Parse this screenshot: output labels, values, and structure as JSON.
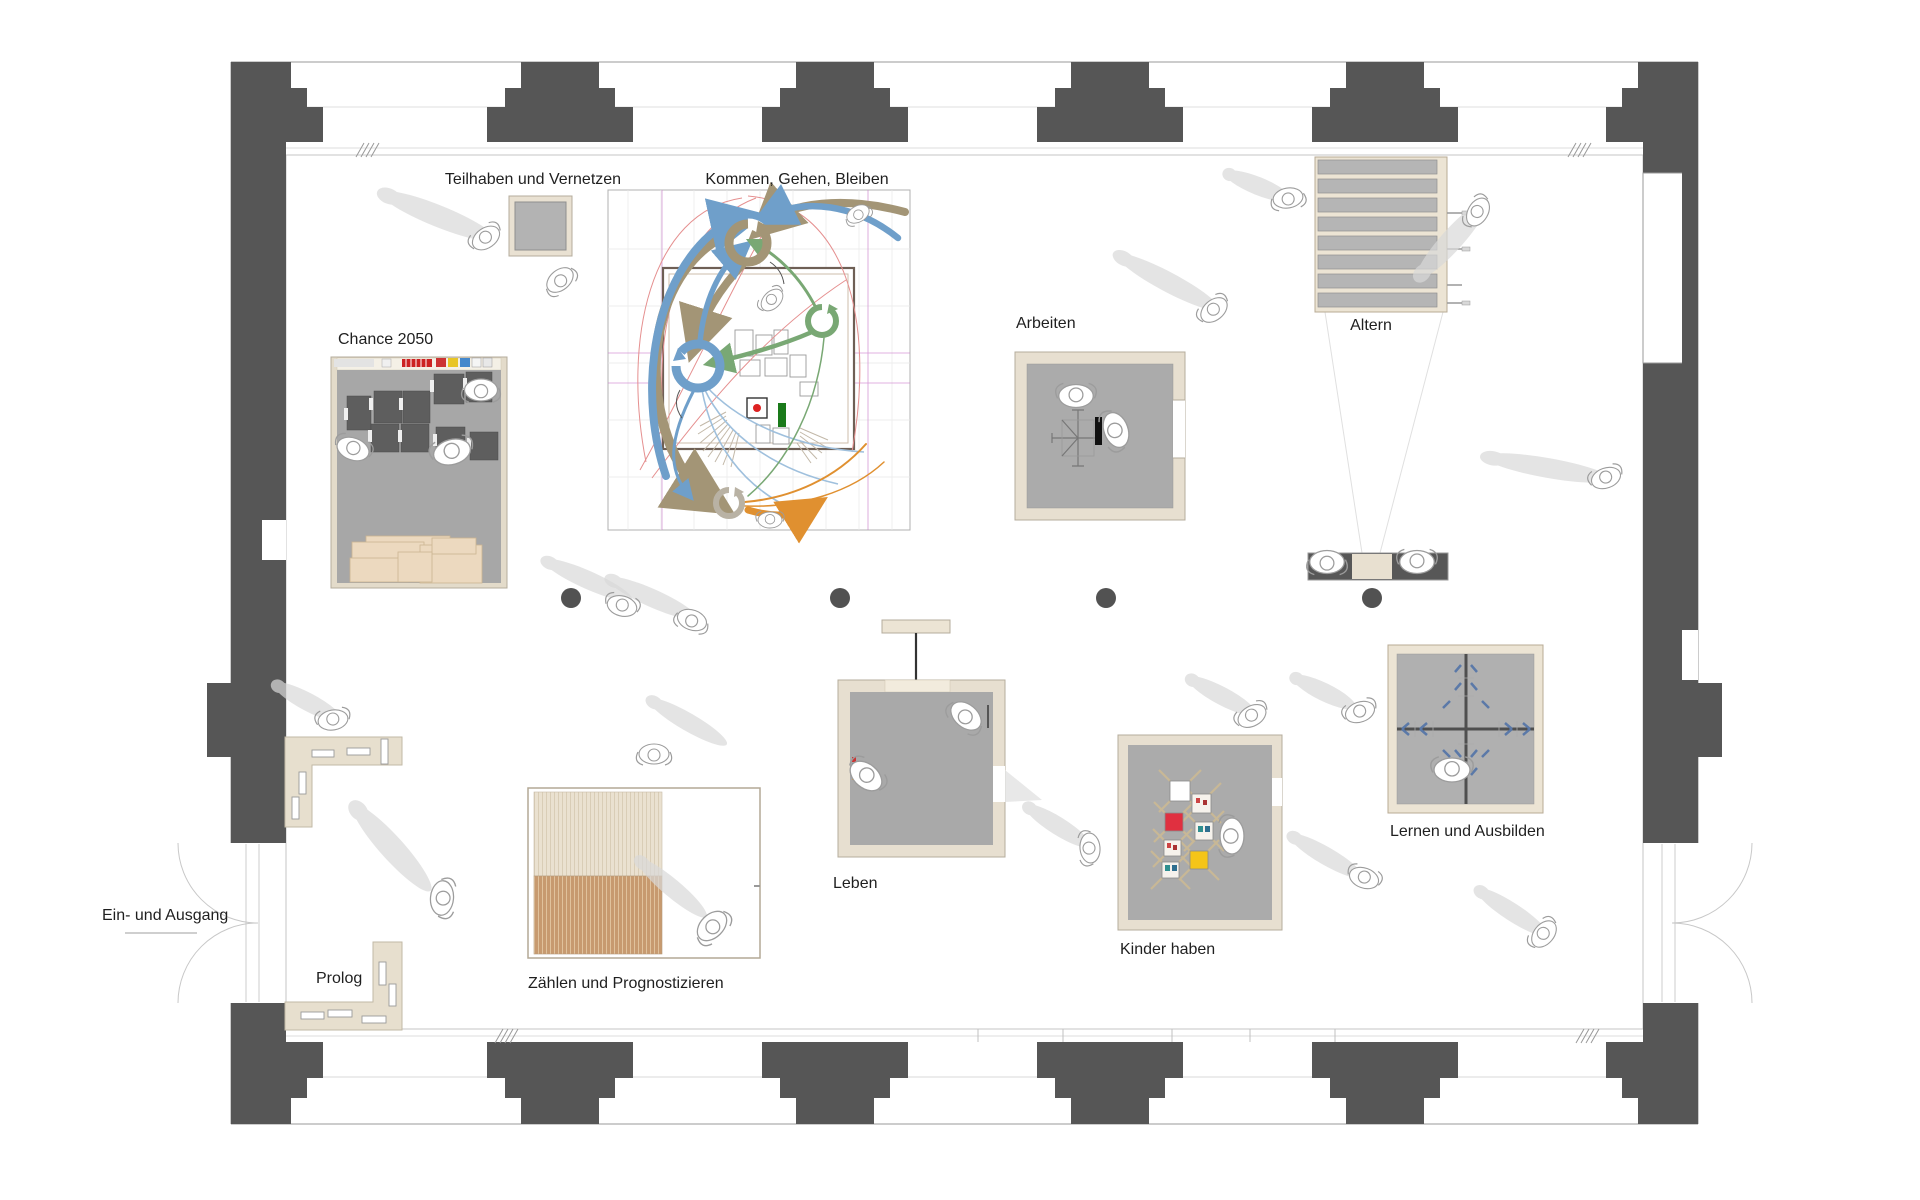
{
  "plan": {
    "entrance_label": "Ein- und Ausgang",
    "stations": {
      "teilhaben": {
        "label": "Teilhaben und Vernetzen"
      },
      "kommen": {
        "label": "Kommen, Gehen, Bleiben"
      },
      "chance": {
        "label": "Chance 2050"
      },
      "arbeiten": {
        "label": "Arbeiten"
      },
      "altern": {
        "label": "Altern"
      },
      "leben": {
        "label": "Leben"
      },
      "kinder": {
        "label": "Kinder haben"
      },
      "lernen": {
        "label": "Lernen und Ausbilden"
      },
      "zaehlen": {
        "label": "Zählen und Prognostizieren"
      },
      "prolog": {
        "label": "Prolog"
      }
    },
    "colors": {
      "wall": "#565656",
      "station_frame": "#e7dfd0",
      "station_floor": "#ababab",
      "accent_khaki": "#a39576",
      "accent_blue": "#6f9fca",
      "accent_green": "#79a874",
      "accent_orange": "#e09030",
      "accent_red": "#e58f8f",
      "accent_magenta": "#cc7fcc",
      "wood": "#c79a6f"
    }
  }
}
